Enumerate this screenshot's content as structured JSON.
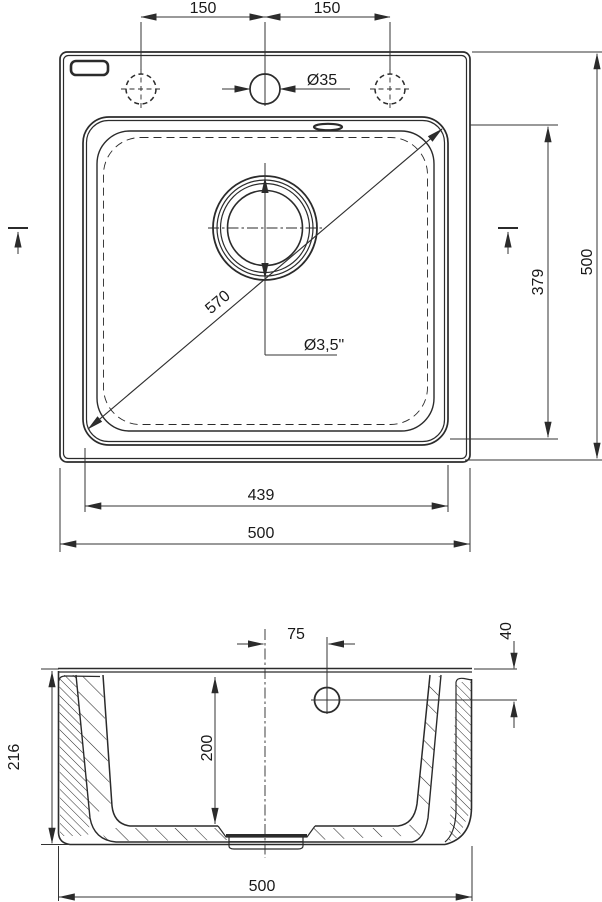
{
  "drawing": {
    "kind": "sink technical drawing",
    "top_view": {
      "dim_150_left": "150",
      "dim_150_right": "150",
      "faucet_hole_dia": "Ø35",
      "diagonal_dim": "570",
      "drain_dia": "Ø3,5\"",
      "bowl_height_dim": "379",
      "overall_height_dim": "500",
      "bowl_width_dim": "439",
      "overall_width_dim": "500"
    },
    "section_view": {
      "hole_offset_dim": "75",
      "hole_drop_dim": "40",
      "overall_depth_dim": "216",
      "bowl_depth_dim": "200",
      "overall_width_dim": "500"
    },
    "colors": {
      "line": "#2b2b2b",
      "text": "#1a1a1a",
      "background": "#ffffff"
    }
  }
}
